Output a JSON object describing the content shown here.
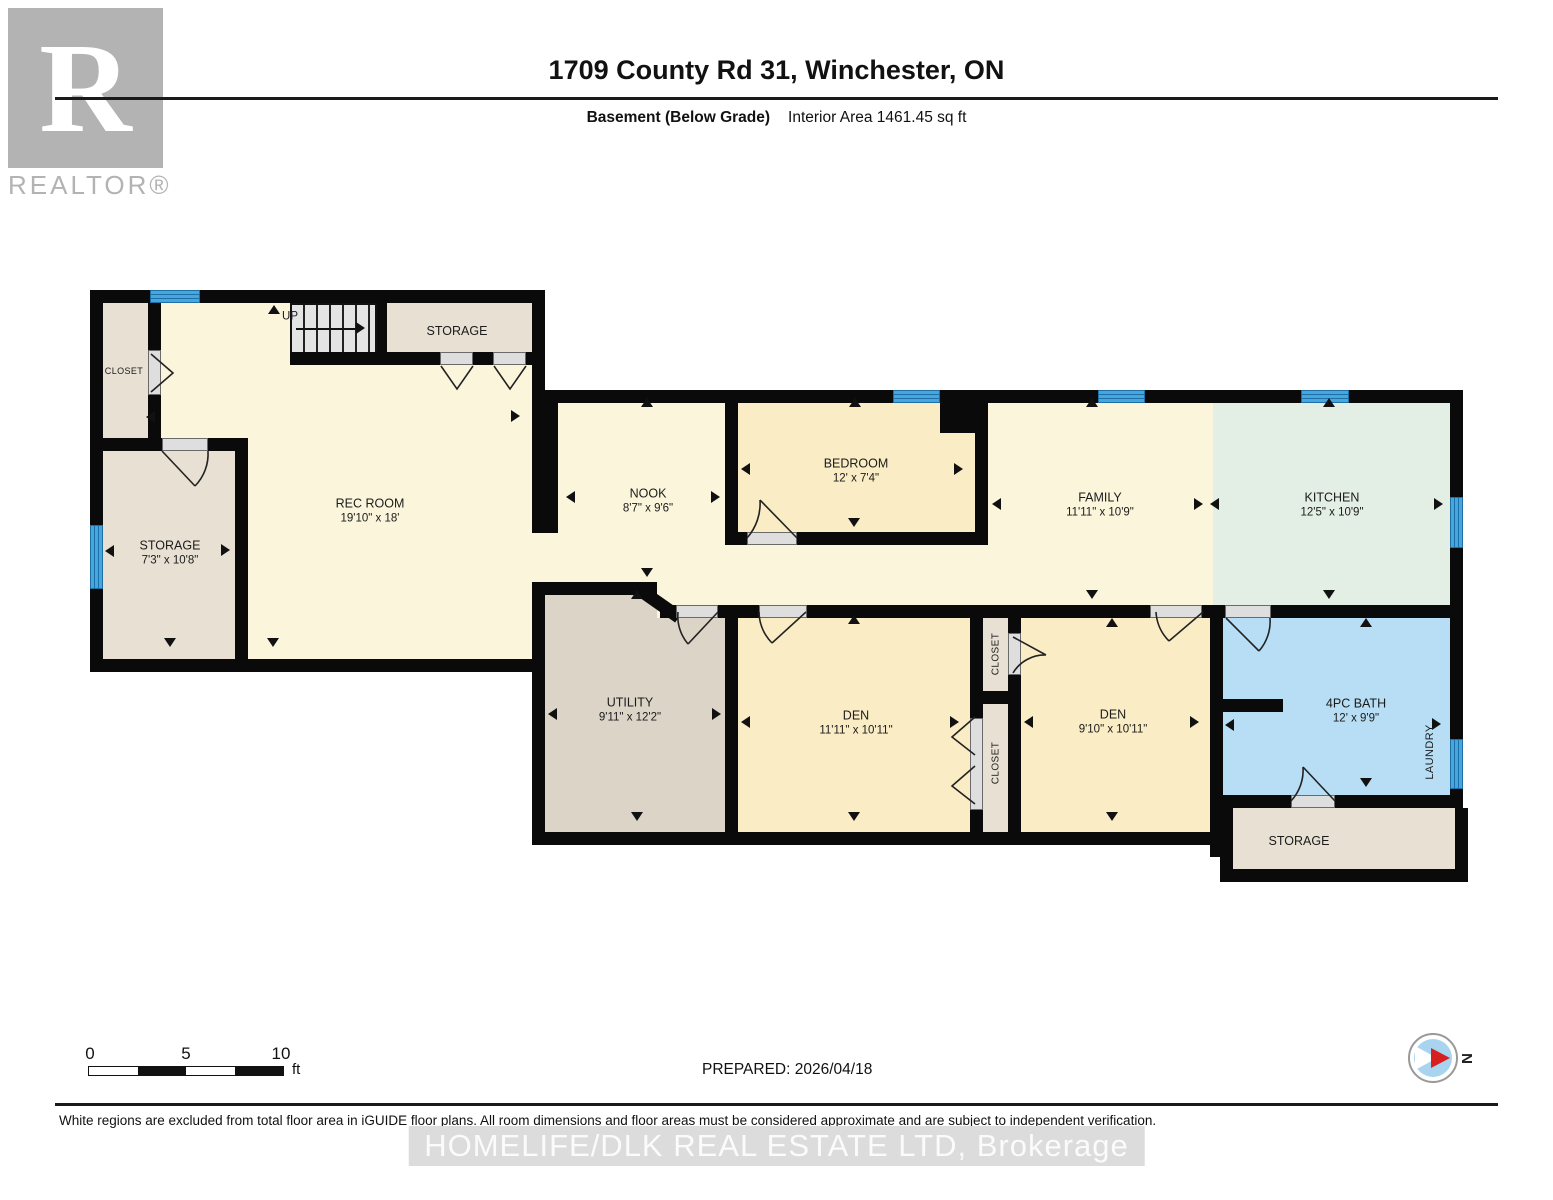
{
  "header": {
    "logo_r": "R",
    "logo_text": "REALTOR®",
    "title": "1709 County Rd 31, Winchester, ON",
    "floor_label": "Basement (Below Grade)",
    "area_label": "Interior Area 1461.45 sq ft"
  },
  "rooms": {
    "closet_left": {
      "name": "CLOSET"
    },
    "stairs": {
      "label": "UP"
    },
    "storage_top": {
      "name": "STORAGE"
    },
    "rec_room": {
      "name": "REC ROOM",
      "dims": "19'10\" x 18'"
    },
    "storage_left": {
      "name": "STORAGE",
      "dims": "7'3\" x 10'8\""
    },
    "nook": {
      "name": "NOOK",
      "dims": "8'7\" x 9'6\""
    },
    "bedroom": {
      "name": "BEDROOM",
      "dims": "12' x 7'4\""
    },
    "family": {
      "name": "FAMILY",
      "dims": "11'11\" x 10'9\""
    },
    "kitchen": {
      "name": "KITCHEN",
      "dims": "12'5\" x 10'9\""
    },
    "utility": {
      "name": "UTILITY",
      "dims": "9'11\" x 12'2\""
    },
    "den_left": {
      "name": "DEN",
      "dims": "11'11\" x 10'11\""
    },
    "den_right": {
      "name": "DEN",
      "dims": "9'10\" x 10'11\""
    },
    "closet_mid_top": {
      "name": "CLOSET"
    },
    "closet_mid_bottom": {
      "name": "CLOSET"
    },
    "bath": {
      "name": "4PC BATH",
      "dims": "12' x 9'9\""
    },
    "laundry": {
      "name": "LAUNDRY"
    },
    "storage_bottom_right": {
      "name": "STORAGE"
    }
  },
  "footer": {
    "scale": {
      "t0": "0",
      "t5": "5",
      "t10": "10",
      "unit": "ft"
    },
    "prepared": "PREPARED: 2026/04/18",
    "compass_label": "N",
    "disclaimer": "White regions are excluded from total floor area in iGUIDE floor plans. All room dimensions and floor areas must be considered approximate and are subject to independent verification.",
    "watermark": "HOMELIFE/DLK REAL ESTATE LTD, Brokerage"
  }
}
